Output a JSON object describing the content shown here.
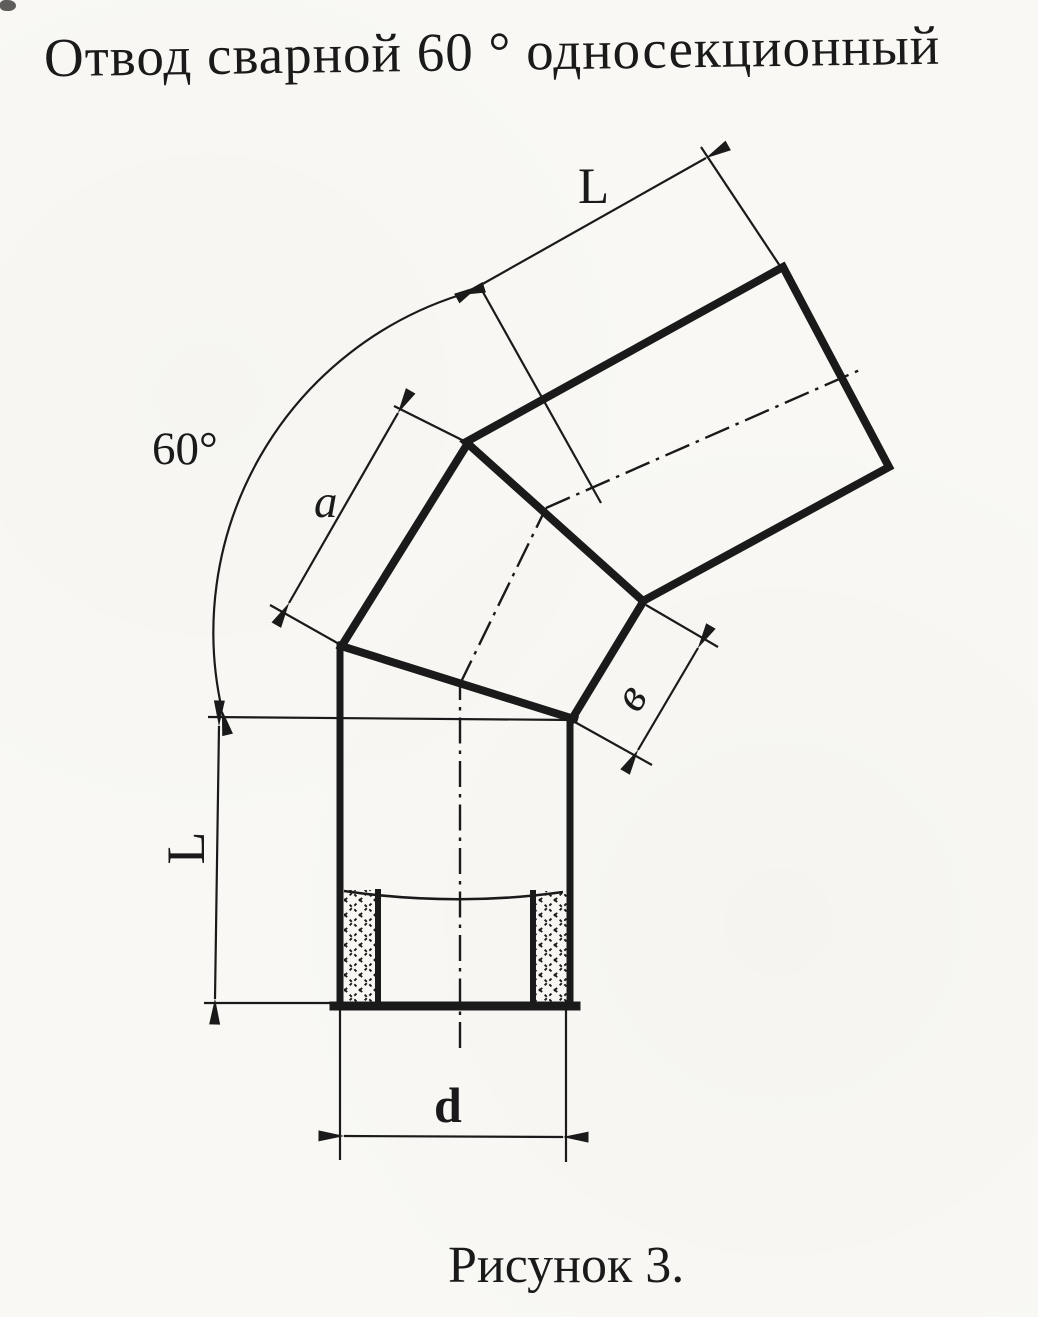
{
  "title": "Отвод сварной 60 ° односекционный",
  "caption": "Рисунок 3.",
  "labels": {
    "angle": "60°",
    "top_length": "L",
    "segment_width_a": "a",
    "segment_width_b": "в",
    "left_length": "L",
    "diameter": "d"
  },
  "colors": {
    "ink": "#1a1a1a",
    "paper": "#f9f8f4"
  }
}
